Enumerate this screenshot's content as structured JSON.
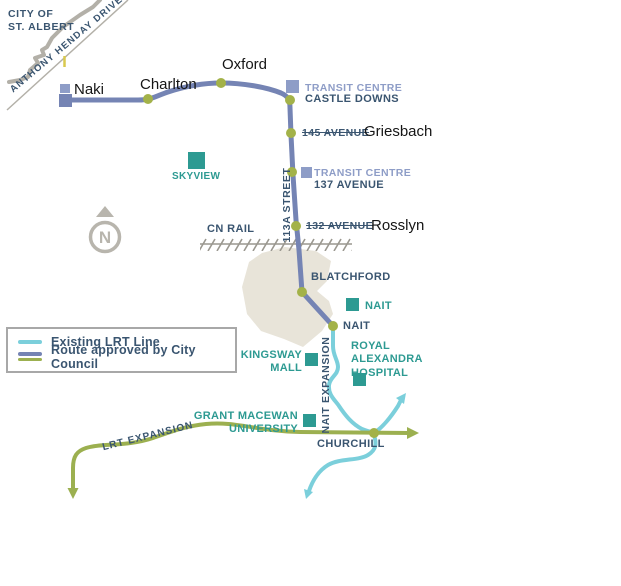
{
  "colors": {
    "navy": "#3a5570",
    "periwinkle": "#8e9dc7",
    "route_blue": "#7584b4",
    "teal": "#2d9a92",
    "existing_lrt": "#7bcfdb",
    "olive": "#9cb050",
    "dot_olive": "#a3b249",
    "label_black": "#151515",
    "beige": "#e8e4d9",
    "road_gray": "#b3b0a8",
    "rail_gray": "#9a978f",
    "compass_gray": "#b8b5ad",
    "legend_border": "#a8a8a8",
    "accent_yellow": "#d9c94e"
  },
  "header": {
    "city_label": "CITY OF\nST. ALBERT",
    "henday_drive": "ANTHONY HENDAY DRIVE"
  },
  "compass": {
    "label": "N"
  },
  "stations": {
    "naki": "Naki",
    "charlton": "Charlton",
    "oxford": "Oxford",
    "castle_downs": {
      "transit_centre": "TRANSIT CENTRE",
      "name": "CASTLE DOWNS"
    },
    "griesbach": {
      "former": "145 AVENUE",
      "name": "Griesbach"
    },
    "ave_137": {
      "transit_centre": "TRANSIT CENTRE",
      "name": "137 AVENUE"
    },
    "rosslyn": {
      "former": "132 AVENUE",
      "name": "Rosslyn"
    },
    "blatchford": "BLATCHFORD",
    "nait": "NAIT",
    "churchill": "CHURCHILL"
  },
  "landmarks": {
    "skyview": "SKYVIEW",
    "nait": "NAIT",
    "kingsway_mall": "KINGSWAY\nMALL",
    "royal_alexandra": "ROYAL\nALEXANDRA\nHOSPITAL",
    "grant_macewan": "GRANT MACEWAN\nUNIVERSITY"
  },
  "routes": {
    "cn_rail": "CN RAIL",
    "street_113a": "113A STREET",
    "nait_expansion": "NAIT EXPANSION",
    "lrt_expansion": "LRT EXPANSION"
  },
  "legend": {
    "items": [
      {
        "label": "Existing LRT Line"
      },
      {
        "label": "Route approved by City Council"
      }
    ]
  }
}
